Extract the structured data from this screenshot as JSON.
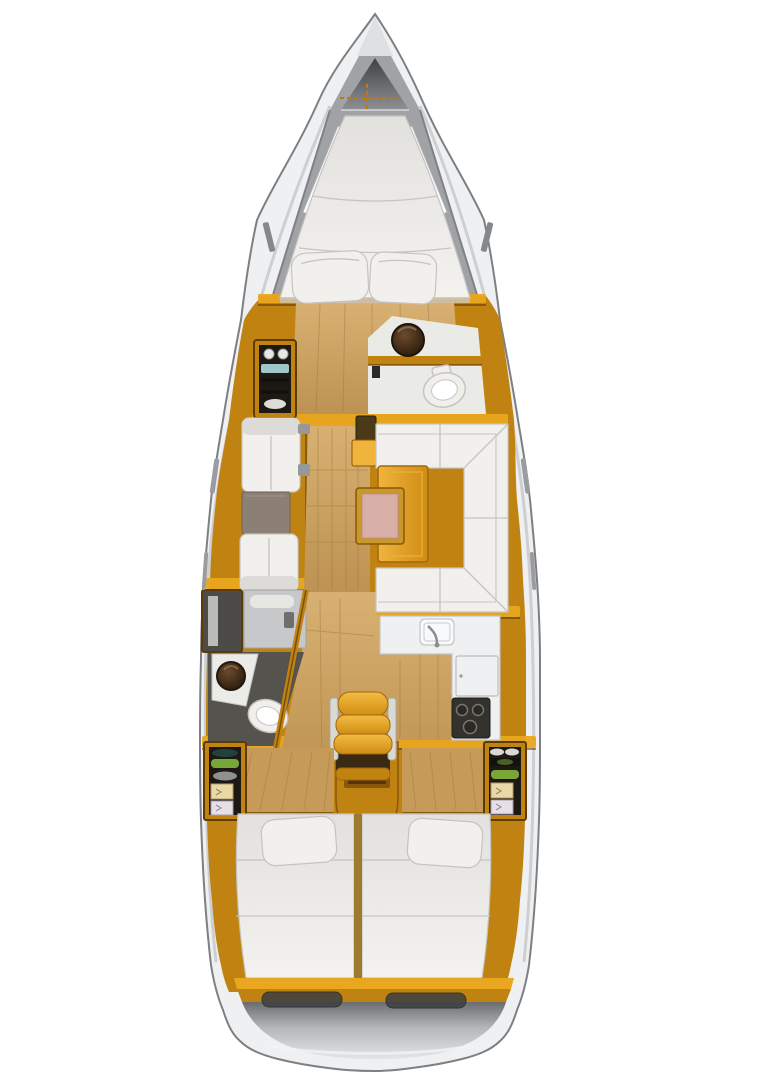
{
  "figure": {
    "title": "Sailboat interior deck plan",
    "kind": "yacht-floor-plan",
    "orientation": "bow-up"
  },
  "colors": {
    "pageBg": "#ffffff",
    "hullFill": "#eff0f1",
    "hullStroke": "#7d8083",
    "hullBand": "#c9cbcd",
    "deckGray": "#a0a2a5",
    "deckEdge": "#7f8184",
    "anchorTop": "#3f4145",
    "anchorBottom": "#8e9093",
    "amberBase": "#c08312",
    "amberBright": "#e9a71f",
    "amberLight": "#f0b43c",
    "amberDark": "#8a5708",
    "amberDeep": "#5e3a05",
    "woodLight": "#d8b172",
    "woodMid": "#bd9252",
    "woodGrain": "#a37b42",
    "woodPanel": "#c69a58",
    "furnWhite": "#f1f0ec",
    "furnShade": "#dcdbd7",
    "seamGray": "#c5c4c0",
    "taupe": "#8c7f75",
    "pinkTop": "#d9b0a8",
    "pinkFrame": "#c9982c",
    "sinkOuter": "#6b4a2c",
    "sinkInner": "#221509",
    "toiletWhite": "#f0efec",
    "grayFloor": "#c6c8ca",
    "darkFloor": "#55534e",
    "lockerGray": "#4c4b47",
    "stoveDark": "#33322f",
    "burnerGray": "#77766f",
    "bottleGreen": "#7aa638",
    "bottleDark": "#4a5e28",
    "tealShelf": "#9fc6c9",
    "dispCream": "#ead9a8",
    "dispWhite": "#e6e0e6",
    "cabinetInterior": "#1c1914",
    "handleGray": "#96989a",
    "hatchDark": "#3c3e40",
    "transomDark": "#6a6c6f",
    "transomLight": "#e4e5e6",
    "railSilver": "#d9d9d5",
    "footwellDark": "#3a2a14",
    "chainOrange": "#c07818"
  },
  "regions": [
    "bow-anchor-locker",
    "v-berth",
    "forward-shelf-cabinet",
    "forward-head",
    "salon-port-seating",
    "salon-dinette",
    "galley",
    "aft-head",
    "companionway-steps",
    "engine-compartment",
    "aft-cabin-port",
    "aft-cabin-starboard",
    "stern-transom"
  ]
}
